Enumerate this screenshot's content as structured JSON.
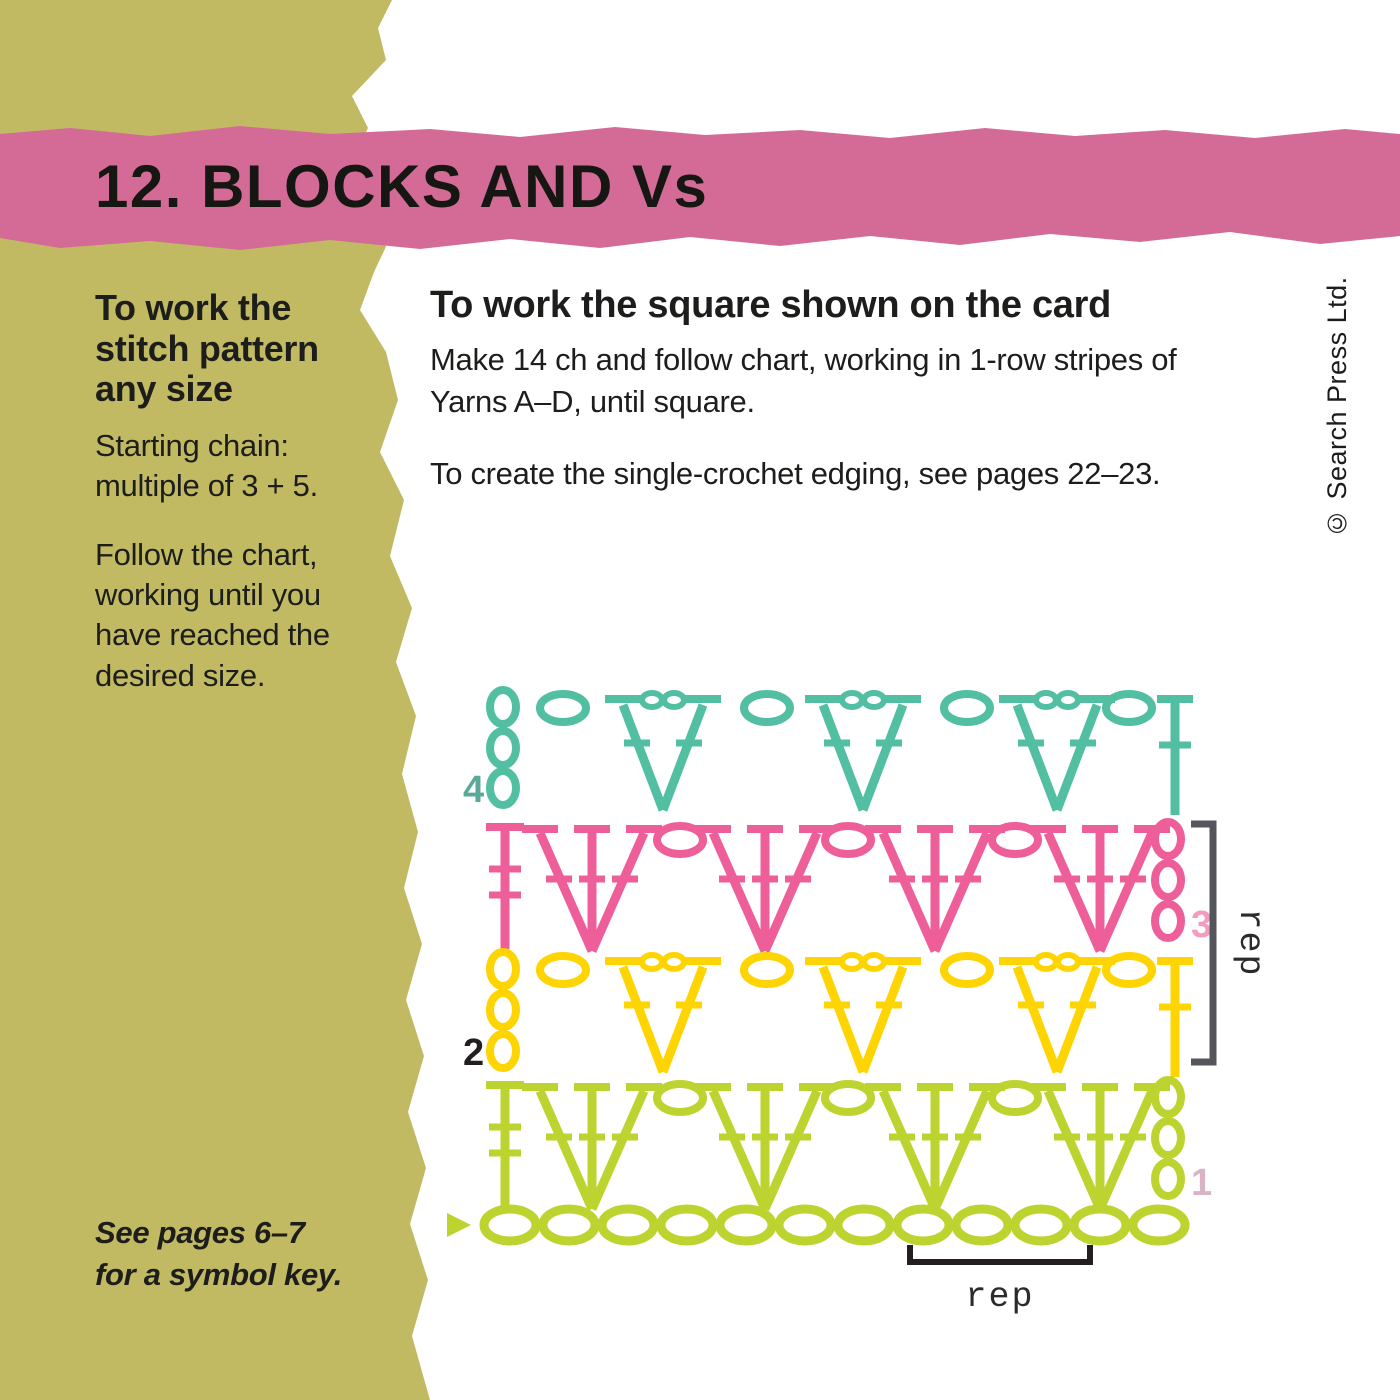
{
  "header": {
    "title": "12. BLOCKS AND Vs",
    "banner_color": "#d36b96",
    "title_color": "#161613"
  },
  "sidebar": {
    "stripe_color": "#c1ba63",
    "heading": "To work the stitch pattern any size",
    "para1": "Starting chain: multiple of 3 + 5.",
    "para2": "Follow the chart, working until you have reached the desired size.",
    "footnote": "See pages 6–7 for a symbol key."
  },
  "main": {
    "heading": "To work the square shown on the card",
    "para1": "Make 14 ch and follow chart, working in 1-row stripes of Yarns A–D, until square.",
    "para2": "To create the single-crochet edging, see pages 22–23."
  },
  "copyright": "© Search Press Ltd.",
  "chart": {
    "type": "crochet-symbol-chart",
    "rows": [
      {
        "number": "4",
        "color": "#53bfa2",
        "label_color": "#5aa89a",
        "v_stitches": 3,
        "chain_ovals": 4,
        "turning_chains": 3,
        "turning_chain_side": "left",
        "dc_side": "right"
      },
      {
        "number": "3",
        "color": "#ee5f9a",
        "label_color": "#f29cc0",
        "shells": 4,
        "chain_ovals": 3,
        "turning_chains": 3,
        "turning_chain_side": "right",
        "dc_side": "left"
      },
      {
        "number": "2",
        "color": "#ffd403",
        "label_color": "#231f20",
        "v_stitches": 3,
        "chain_ovals": 4,
        "turning_chains": 3,
        "turning_chain_side": "left",
        "dc_side": "right"
      },
      {
        "number": "1",
        "color": "#bdd32f",
        "label_color": "#d9b4c4",
        "shells": 4,
        "chain_ovals": 3,
        "turning_chains": 3,
        "turning_chain_side": "right",
        "dc_side": "left"
      }
    ],
    "foundation": {
      "color": "#bdd32f",
      "chain_count": 12,
      "start_marker": "right-pointing triangle"
    },
    "side_rep_label": "rep",
    "bottom_rep_label": "rep",
    "side_bracket_color": "#55565b",
    "bottom_bracket_color": "#231f20"
  }
}
